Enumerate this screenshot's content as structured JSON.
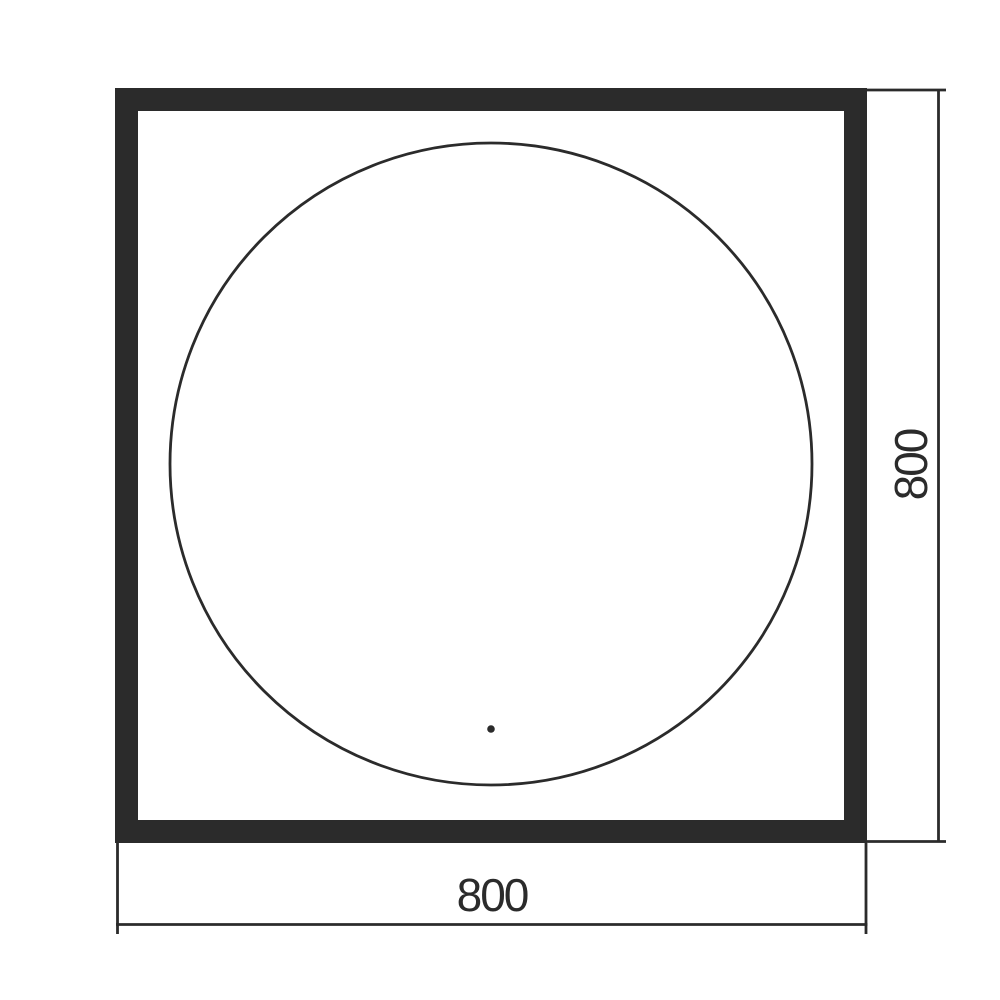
{
  "diagram": {
    "line_color": "#2b2b2b",
    "background_color": "#ffffff",
    "bottom_dimension": {
      "label": "800"
    },
    "right_dimension": {
      "label": "800"
    }
  }
}
